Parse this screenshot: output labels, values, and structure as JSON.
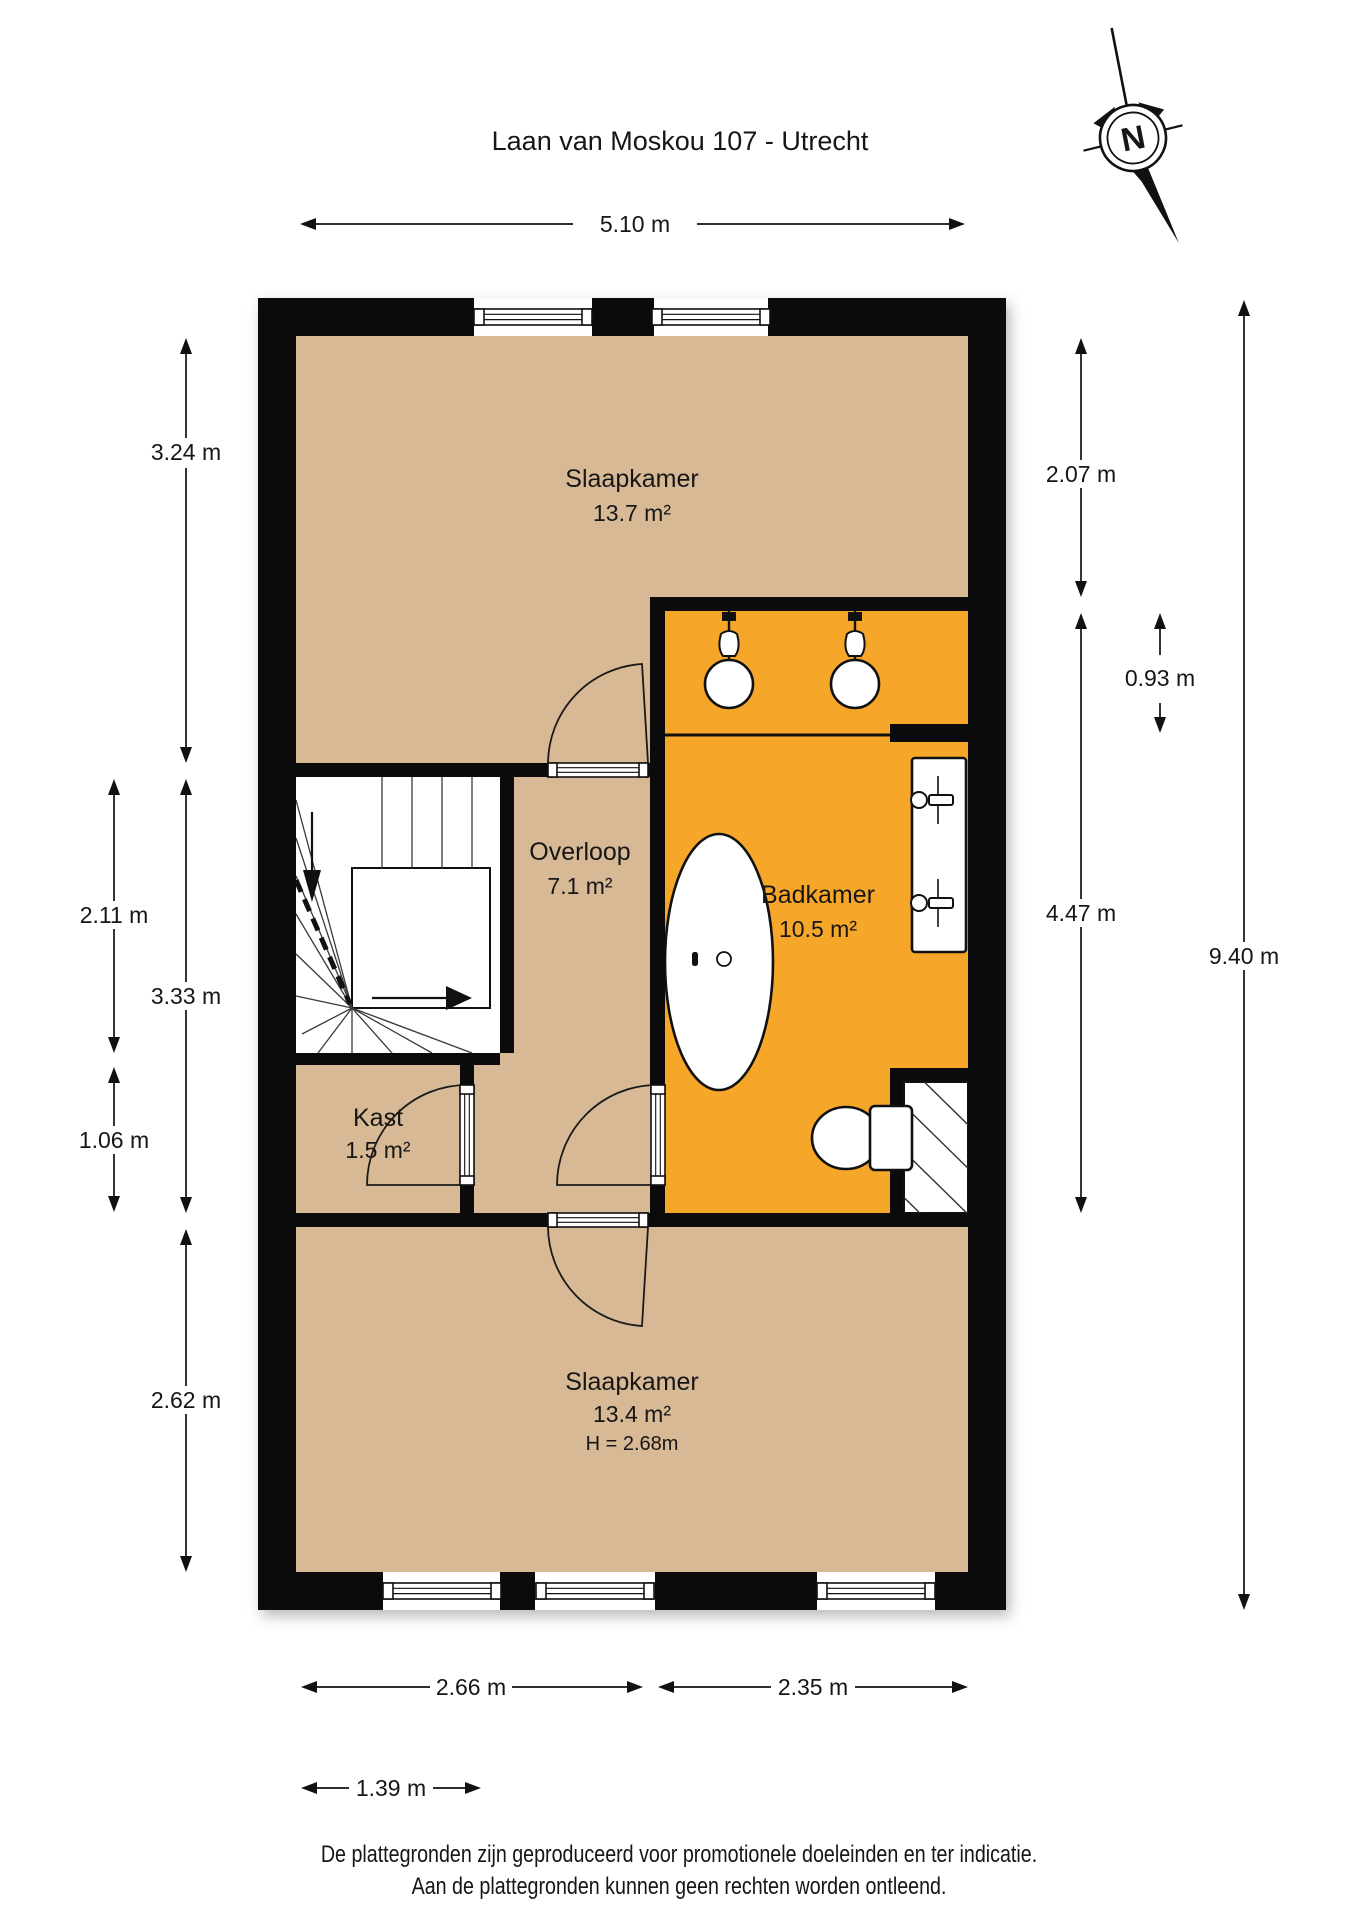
{
  "title": "Laan van Moskou 107 - Utrecht",
  "compass": {
    "label": "N"
  },
  "rooms": {
    "slaapkamer1": {
      "name": "Slaapkamer",
      "area": "13.7 m²"
    },
    "overloop": {
      "name": "Overloop",
      "area": "7.1 m²"
    },
    "badkamer": {
      "name": "Badkamer",
      "area": "10.5 m²"
    },
    "kast": {
      "name": "Kast",
      "area": "1.5 m²"
    },
    "slaapkamer2": {
      "name": "Slaapkamer",
      "area": "13.4 m²",
      "ceiling_height": "H = 2.68m"
    }
  },
  "dimensions": {
    "top": "5.10 m",
    "left": {
      "slaapkamer1": "3.24 m",
      "stairs": "2.11 m",
      "overloop": "3.33 m",
      "kast": "1.06 m",
      "slaapkamer2": "2.62 m"
    },
    "right": {
      "slaapkamer1_right": "2.07 m",
      "shower_zone": "0.93 m",
      "badkamer": "4.47 m",
      "total_height": "9.40 m"
    },
    "bottom": {
      "slaapkamer2_left": "2.66 m",
      "slaapkamer2_right": "2.35 m",
      "entry": "1.39 m"
    }
  },
  "footer": {
    "line1": "De plattegronden zijn geproduceerd voor promotionele doeleinden en ter indicatie.",
    "line2": "Aan de plattegronden kunnen geen rechten worden ontleend."
  },
  "colors": {
    "floor_tan": "#d8b996",
    "bathroom_orange": "#f6a72b",
    "wall_black": "#0b0b0b"
  }
}
